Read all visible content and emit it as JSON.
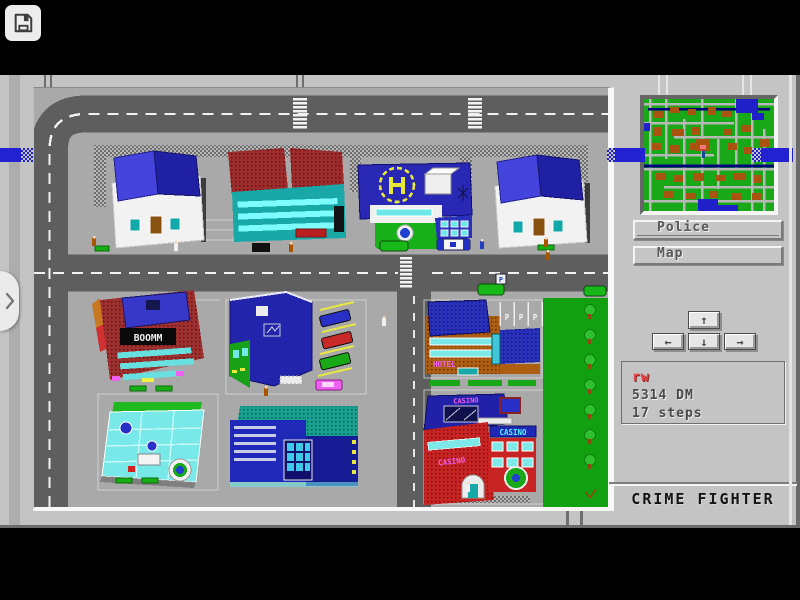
{
  "toolbar": {
    "save_icon": "floppy-disk"
  },
  "edge_drawer": {
    "chevron_icon": "chevron-right"
  },
  "sidebar": {
    "buttons": [
      {
        "label": "Police"
      },
      {
        "label": "Map"
      }
    ],
    "dpad": {
      "up_icon": "↑",
      "down_icon": "↓",
      "left_icon": "←",
      "right_icon": "→"
    },
    "status": {
      "player_name": "rw",
      "money": "5314 DM",
      "steps": "17 steps"
    },
    "title": "CRIME FIGHTER",
    "minimap_colors": {
      "land": "#18A818",
      "road": "#B8B8B8",
      "building": "#A85410",
      "water": "#2020C8",
      "player_marker": "#F87878"
    }
  },
  "city": {
    "signs": {
      "disco": "BOOMM",
      "hotel": "HOTEL",
      "casino_roof": "CASINO",
      "casino_marquee": "CASINO",
      "casino_wall": "CASINO",
      "parking_spots": [
        "P",
        "P",
        "P"
      ],
      "parking_sign": "P"
    },
    "colors": {
      "road": "#5E5E5E",
      "sidewalk": "#A9A9A9",
      "park": "#10A010",
      "overlay_band": "#2222D2",
      "frame": "#C4C4C4"
    }
  }
}
